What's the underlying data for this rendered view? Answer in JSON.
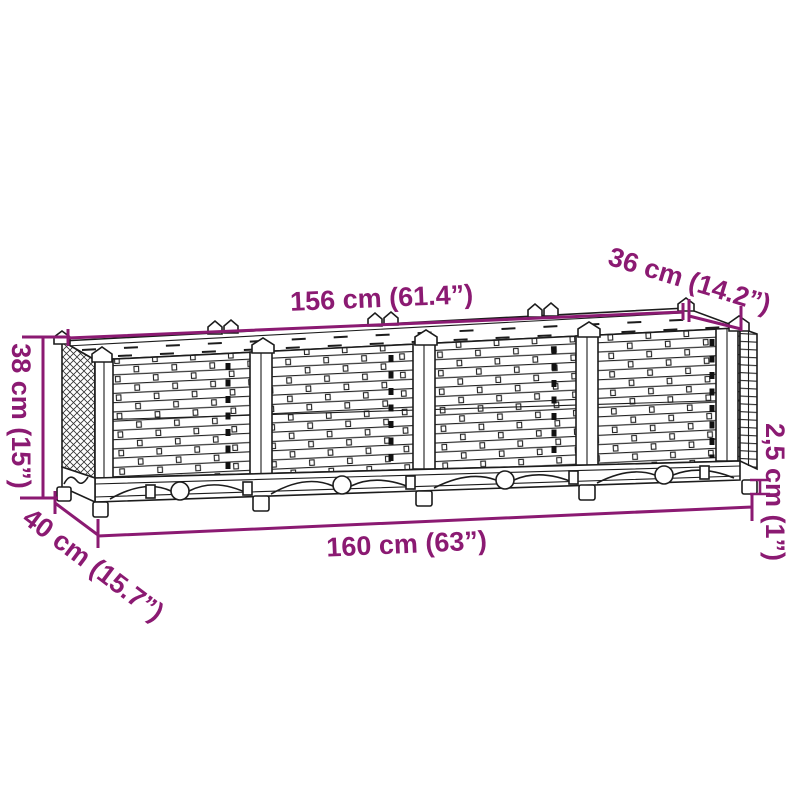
{
  "diagram": {
    "kind": "product dimension diagram",
    "subject": "rattan-weave raised garden bed planter with 4 front sections, arched base skirt and feet",
    "colors": {
      "accent": "#8b1a72",
      "line": "#1c1c1c",
      "background": "#ffffff"
    },
    "dimensions": {
      "top_width": {
        "label": "156 cm (61.4”)",
        "cm": 156,
        "inches": 61.4
      },
      "top_depth": {
        "label": "36 cm (14.2”)",
        "cm": 36,
        "inches": 14.2
      },
      "height": {
        "label": "38 cm (15”)",
        "cm": 38,
        "inches": 15
      },
      "bottom_depth": {
        "label": "40 cm (15.7”)",
        "cm": 40,
        "inches": 15.7
      },
      "bottom_width": {
        "label": "160 cm (63”)",
        "cm": 160,
        "inches": 63
      },
      "foot_height": {
        "label": "2,5 cm (1”)",
        "cm": 2.5,
        "inches": 1
      }
    }
  }
}
